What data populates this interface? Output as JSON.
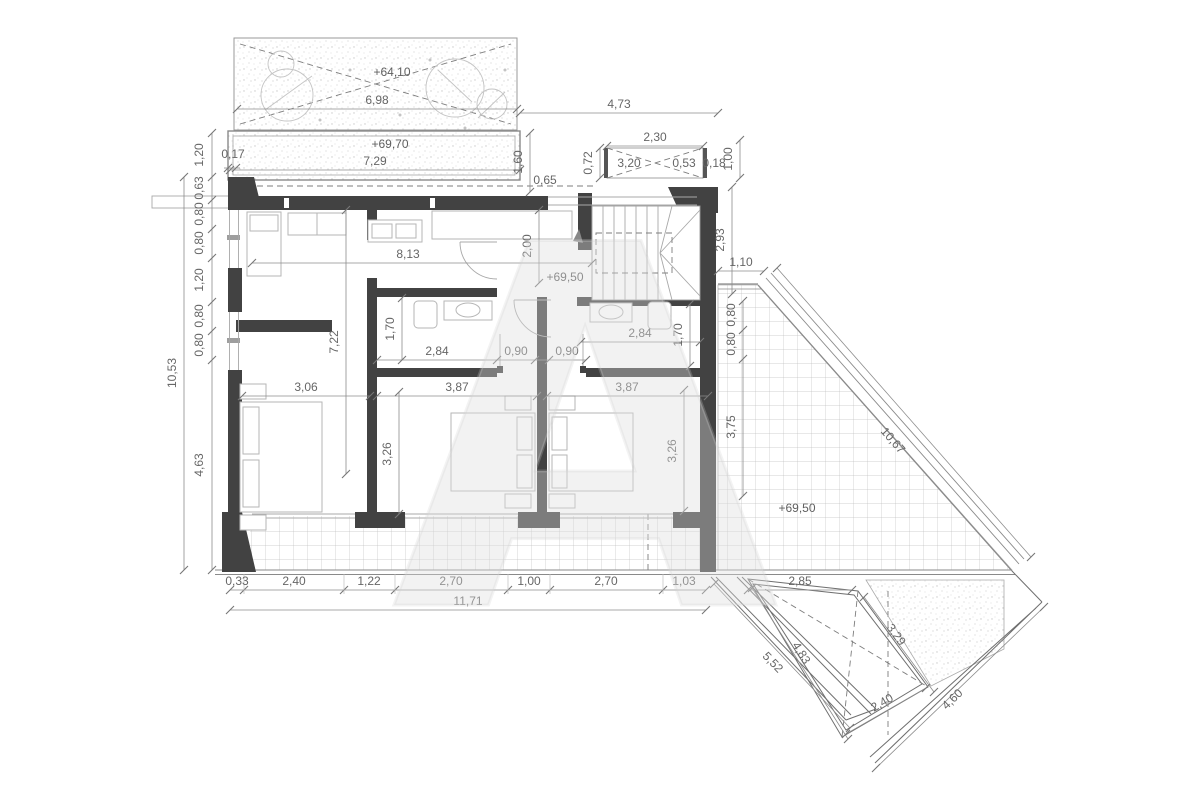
{
  "drawing": {
    "type": "architectural-floor-plan",
    "watermark": "A",
    "colors": {
      "wall": "#424242",
      "dim_line": "#8c8c8c",
      "label_text": "#666666",
      "light_line": "#b5b5b5"
    },
    "levels": {
      "l6410": "+64,10",
      "l6970": "+69,70",
      "l6950a": "+69,50",
      "l6950b": "+69,50"
    },
    "dims": {
      "d698": "6,98",
      "d473": "4,73",
      "d729": "7,29",
      "d017": "0,17",
      "d230": "2,30",
      "d320": "3,20",
      "d053": "0,53",
      "d018": "0,18",
      "d072": "0,72",
      "d100a": "1,00",
      "d160": "1,60",
      "d065": "0,65",
      "d120a": "1,20",
      "d063": "0,63",
      "d080a": "0,80",
      "d080b": "0,80",
      "d120b": "1,20",
      "d080c": "0,80",
      "d080d": "0,80",
      "d463": "4,63",
      "d1053": "10,53",
      "d200": "2,00",
      "d293": "2,93",
      "d110": "1,10",
      "d813": "8,13",
      "d170a": "1,70",
      "d284a": "2,84",
      "d090a": "0,90",
      "d090b": "0,90",
      "d284b": "2,84",
      "d170b": "1,70",
      "d080e": "0,80",
      "d080f": "0,80",
      "d375": "3,75",
      "d1067": "10,67",
      "d306": "3,06",
      "d387a": "3,87",
      "d387b": "3,87",
      "d722": "7,22",
      "d326a": "3,26",
      "d326b": "3,26",
      "d033": "0,33",
      "d240a": "2,40",
      "d122": "1,22",
      "d270a": "2,70",
      "d100b": "1,00",
      "d270b": "2,70",
      "d103": "1,03",
      "d1171": "11,71",
      "d285": "2,85",
      "d483": "4,83",
      "d329": "3,29",
      "d552": "5,52",
      "d240c": "2,40",
      "d460": "4,60"
    }
  }
}
